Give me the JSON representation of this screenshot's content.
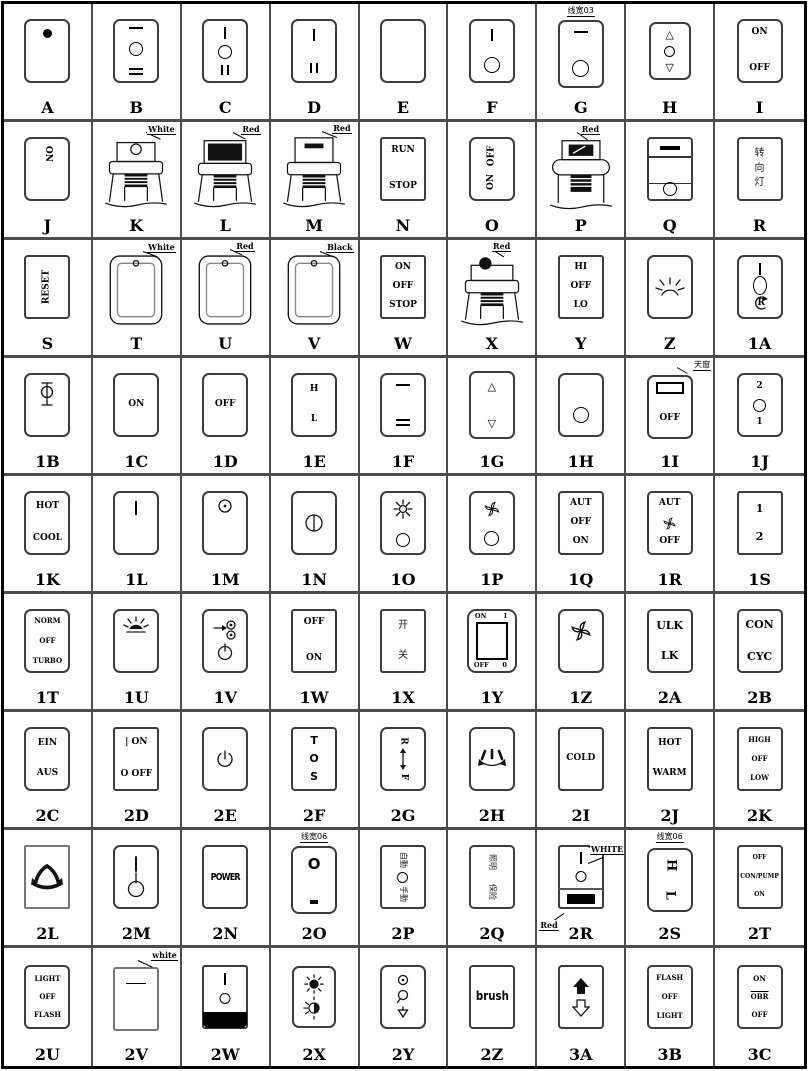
{
  "cells": {
    "A": {
      "code": "A"
    },
    "B": {
      "code": "B"
    },
    "C": {
      "code": "C"
    },
    "D": {
      "code": "D"
    },
    "E": {
      "code": "E"
    },
    "F": {
      "code": "F"
    },
    "G": {
      "code": "G",
      "ann": "线宽03"
    },
    "H": {
      "code": "H"
    },
    "I": {
      "code": "I",
      "t1": "ON",
      "t2": "OFF"
    },
    "J": {
      "code": "J",
      "t1": "ON"
    },
    "K": {
      "code": "K",
      "ann": "White"
    },
    "L": {
      "code": "L",
      "ann": "Red"
    },
    "M": {
      "code": "M",
      "ann": "Red"
    },
    "N": {
      "code": "N",
      "t1": "RUN",
      "t2": "STOP"
    },
    "O": {
      "code": "O",
      "t1": "OFF",
      "t2": "ON"
    },
    "P": {
      "code": "P",
      "ann": "Red"
    },
    "Q": {
      "code": "Q"
    },
    "R": {
      "code": "R",
      "t1": "转",
      "t2": "向",
      "t3": "灯"
    },
    "S": {
      "code": "S",
      "t1": "RESET"
    },
    "T": {
      "code": "T",
      "ann": "White"
    },
    "U": {
      "code": "U",
      "ann": "Red"
    },
    "V": {
      "code": "V",
      "ann": "Black"
    },
    "W": {
      "code": "W",
      "t1": "ON",
      "t2": "OFF",
      "t3": "STOP"
    },
    "X": {
      "code": "X",
      "ann": "Red"
    },
    "Y": {
      "code": "Y",
      "t1": "HI",
      "t2": "OFF",
      "t3": "LO"
    },
    "Z": {
      "code": "Z"
    },
    "1A": {
      "code": "1A",
      "t1": "R"
    },
    "1B": {
      "code": "1B"
    },
    "1C": {
      "code": "1C",
      "t1": "ON"
    },
    "1D": {
      "code": "1D",
      "t1": "OFF"
    },
    "1E": {
      "code": "1E",
      "t1": "H",
      "t2": "L"
    },
    "1F": {
      "code": "1F"
    },
    "1G": {
      "code": "1G"
    },
    "1H": {
      "code": "1H"
    },
    "1I": {
      "code": "1I",
      "t1": "OFF",
      "ann": "天窗"
    },
    "1J": {
      "code": "1J",
      "t1": "2",
      "t2": "1"
    },
    "1K": {
      "code": "1K",
      "t1": "HOT",
      "t2": "COOL"
    },
    "1L": {
      "code": "1L"
    },
    "1M": {
      "code": "1M"
    },
    "1N": {
      "code": "1N"
    },
    "1O": {
      "code": "1O"
    },
    "1P": {
      "code": "1P"
    },
    "1Q": {
      "code": "1Q",
      "t1": "AUT",
      "t2": "OFF",
      "t3": "ON"
    },
    "1R": {
      "code": "1R",
      "t1": "AUT",
      "t2": "OFF"
    },
    "1S": {
      "code": "1S",
      "t1": "1",
      "t2": "2"
    },
    "1T": {
      "code": "1T",
      "t1": "NORM",
      "t2": "OFF",
      "t3": "TURBO"
    },
    "1U": {
      "code": "1U"
    },
    "1V": {
      "code": "1V"
    },
    "1W": {
      "code": "1W",
      "t1": "OFF",
      "t2": "ON"
    },
    "1X": {
      "code": "1X",
      "t1": "开",
      "t2": "关"
    },
    "1Y": {
      "code": "1Y",
      "t1": "ON",
      "t2": "I",
      "t3": "OFF",
      "t4": "0"
    },
    "1Z": {
      "code": "1Z"
    },
    "2A": {
      "code": "2A",
      "t1": "ULK",
      "t2": "LK"
    },
    "2B": {
      "code": "2B",
      "t1": "CON",
      "t2": "CYC"
    },
    "2C": {
      "code": "2C",
      "t1": "EIN",
      "t2": "AUS"
    },
    "2D": {
      "code": "2D",
      "t1": "| ON",
      "t2": "O OFF"
    },
    "2E": {
      "code": "2E"
    },
    "2F": {
      "code": "2F",
      "t1": "T",
      "t2": "O",
      "t3": "S"
    },
    "2G": {
      "code": "2G",
      "t1": "R",
      "t2": "F"
    },
    "2H": {
      "code": "2H"
    },
    "2I": {
      "code": "2I",
      "t1": "COLD"
    },
    "2J": {
      "code": "2J",
      "t1": "HOT",
      "t2": "WARM"
    },
    "2K": {
      "code": "2K",
      "t1": "HIGH",
      "t2": "OFF",
      "t3": "LOW"
    },
    "2L": {
      "code": "2L"
    },
    "2M": {
      "code": "2M"
    },
    "2N": {
      "code": "2N",
      "t1": "POWER"
    },
    "2O": {
      "code": "2O",
      "t1": "O",
      "ann": "线宽06"
    },
    "2P": {
      "code": "2P",
      "t1": "自動",
      "t2": "手動"
    },
    "2Q": {
      "code": "2Q",
      "t1": "照明",
      "t2": "保险"
    },
    "2R": {
      "code": "2R",
      "ann": "WHITE",
      "ann2": "Red"
    },
    "2S": {
      "code": "2S",
      "t1": "H",
      "t2": "L",
      "ann": "线宽06"
    },
    "2T": {
      "code": "2T",
      "t1": "OFF",
      "t2": "CON/PUMP",
      "t3": "ON"
    },
    "2U": {
      "code": "2U",
      "t1": "LIGHT",
      "t2": "OFF",
      "t3": "FLASH"
    },
    "2V": {
      "code": "2V",
      "ann": "white"
    },
    "2W": {
      "code": "2W"
    },
    "2X": {
      "code": "2X"
    },
    "2Y": {
      "code": "2Y"
    },
    "2Z": {
      "code": "2Z",
      "t1": "brush"
    },
    "3A": {
      "code": "3A"
    },
    "3B": {
      "code": "3B",
      "t1": "FLASH",
      "t2": "OFF",
      "t3": "LIGHT"
    },
    "3C": {
      "code": "3C",
      "t1": "ON",
      "t2": "OBR",
      "t3": "OFF"
    }
  }
}
